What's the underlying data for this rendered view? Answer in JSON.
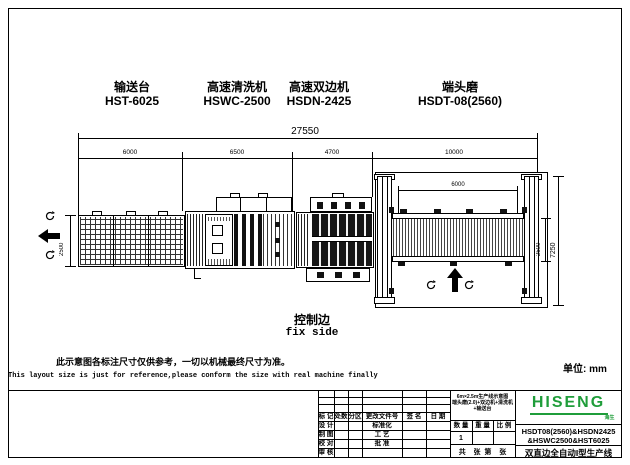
{
  "machines": [
    {
      "name_cn": "输送台",
      "model": "HST-6025"
    },
    {
      "name_cn": "高速清洗机",
      "model": "HSWC-2500"
    },
    {
      "name_cn": "高速双边机",
      "model": "HSDN-2425"
    },
    {
      "name_cn": "端头磨",
      "model": "HSDT-08(2560)"
    }
  ],
  "dimensions": {
    "total": "27550",
    "segments": [
      "6000",
      "6500",
      "4700",
      "10000"
    ],
    "conveyor_width": "2500",
    "grinder_inner_length": "6000",
    "grinder_belt_width": "2500",
    "grinder_total_width": "7250"
  },
  "labels": {
    "control_edge_cn": "控制边",
    "control_edge_en": "fix side",
    "unit": "单位: mm"
  },
  "notes": {
    "cn": "此示意图各标注尺寸仅供参考，一切以机械最终尺寸为准。",
    "en": "This layout size is just for reference,please conform the size with real machine finally"
  },
  "titleblock": {
    "rev_header": [
      "标 记",
      "处数",
      "分区",
      "更改文件号",
      "签 名",
      "日 期"
    ],
    "left_rows": [
      [
        "设 计",
        "标准化"
      ],
      [
        "制 图",
        "工 艺"
      ],
      [
        "校 对",
        "批 准"
      ],
      [
        "审 核",
        ""
      ]
    ],
    "qty_header": [
      "数 量",
      "重 量",
      "比 例"
    ],
    "qty_value": "1",
    "sheet_row": "共    张  第    张",
    "drawing_title_line1": "6m×2.5m生产线示意图",
    "drawing_title_line2": "端头磨(2.0)+双边机+清洗机+输送台",
    "logo_text": "HISENG",
    "logo_sub": "海生",
    "model_line1": "HSDT08(2560)&HSDN2425",
    "model_line2": "&HSWC2500&HST6025",
    "product_name": "双直边全自动I型生产线"
  },
  "colors": {
    "line": "#000000",
    "logo_green": "#1f9d3a"
  }
}
